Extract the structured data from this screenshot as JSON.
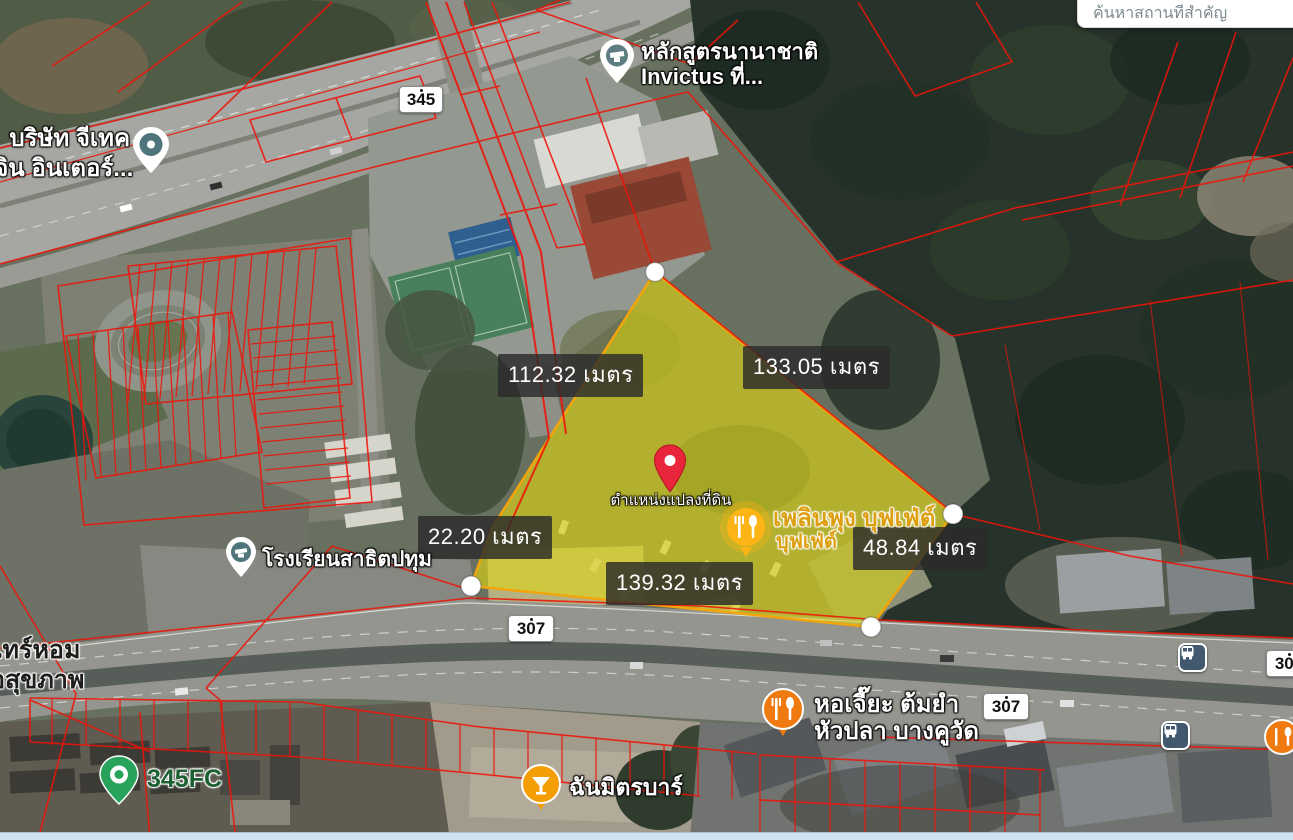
{
  "search": {
    "placeholder": "ค้นหาสถานที่สำคัญ"
  },
  "plot": {
    "pin_label": "ตำแหน่งแปลงที่ดิน",
    "measurements": {
      "left": "112.32 เมตร",
      "right": "133.05 เมตร",
      "lower_left": "22.20 เมตร",
      "lower_right": "48.84 เมตร",
      "bottom": "139.32 เมตร"
    }
  },
  "badges": {
    "r345": "345",
    "r307": "307"
  },
  "places": {
    "invictus": {
      "line1": "หลักสูตรนานาชาติ",
      "line2": "Invictus ที่..."
    },
    "gtech": {
      "line1": "บริษัท จีเทค",
      "line2": "เจิน อินเตอร์..."
    },
    "school": {
      "name": "โรงเรียนสาธิตปทุม"
    },
    "ploenpung": {
      "line1": "เพลินพุง บุฟเฟ่ต์",
      "line2": "บุฟเฟ่ต์"
    },
    "horjia": {
      "line1": "หอเจี๊ยะ ต้มยำ",
      "line2": "หัวปลา บางคูวัด"
    },
    "fc345": {
      "name": "345FC"
    },
    "chanmit": {
      "name": "ฉันมิตรบาร์"
    },
    "healthhome": {
      "line1": "เทร์หอม",
      "line2": "อสุขภาพ"
    }
  },
  "colors": {
    "plot_fill": "#e8e000",
    "plot_stroke": "#f2a50a",
    "parcel_line": "#ee1409",
    "label_bg": "#2b2b2b"
  }
}
